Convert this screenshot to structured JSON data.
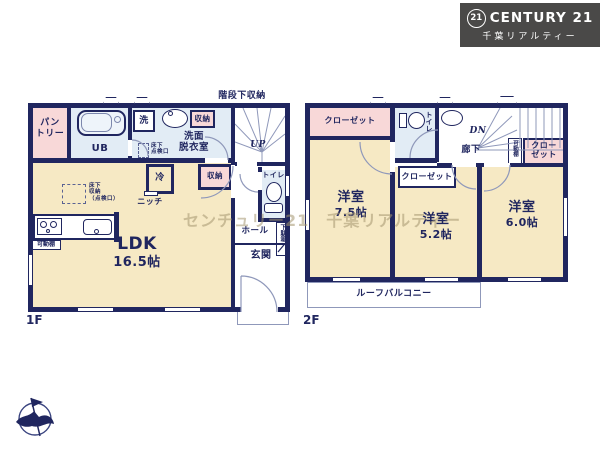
{
  "colors": {
    "wall_navy": "#20265f",
    "room_tan": "#f6e9c4",
    "closet_pink": "#f8d8d8",
    "wet_area_blue": "#e2ecf5",
    "logo_background": "#4a4948",
    "watermark_tint": "#a49570"
  },
  "logo": {
    "seal": "21",
    "brand": "CENTURY 21",
    "company": "千葉リアルティー"
  },
  "watermark": "センチュリー21　千葉リアルティー",
  "floor1": {
    "label": "1F",
    "stair_storage": "階段下収納",
    "pantry": "パン\nトリー",
    "unit_bath": "UB",
    "washer": "洗",
    "storage_top": "収納",
    "washroom": "洗面\n脱衣室",
    "underfloor_hatch": "床下\n点検口",
    "stairs_up": "UP",
    "fridge": "冷",
    "storage_mid": "収納",
    "toilet": "トイレ",
    "niche": "ニッチ",
    "underfloor_storage": "床下\n収納\n（点検口）",
    "movable_shelf": "可動棚",
    "ldk_name": "LDK",
    "ldk_size": "16.5帖",
    "hall": "ホール",
    "shoe_cabinet": "下駄箱",
    "entrance": "玄関"
  },
  "floor2": {
    "label": "2F",
    "closet_room1": "クローゼット",
    "toilet": "トイレ",
    "stairs_down": "DN",
    "corridor": "廊下",
    "movable_shelf": "可動棚",
    "closet_room2": "クローゼット",
    "closet_room3": "クロー\nゼット",
    "room1_name": "洋室",
    "room1_size": "7.5帖",
    "room2_name": "洋室",
    "room2_size": "5.2帖",
    "room3_name": "洋室",
    "room3_size": "6.0帖",
    "balcony": "ルーフバルコニー"
  }
}
